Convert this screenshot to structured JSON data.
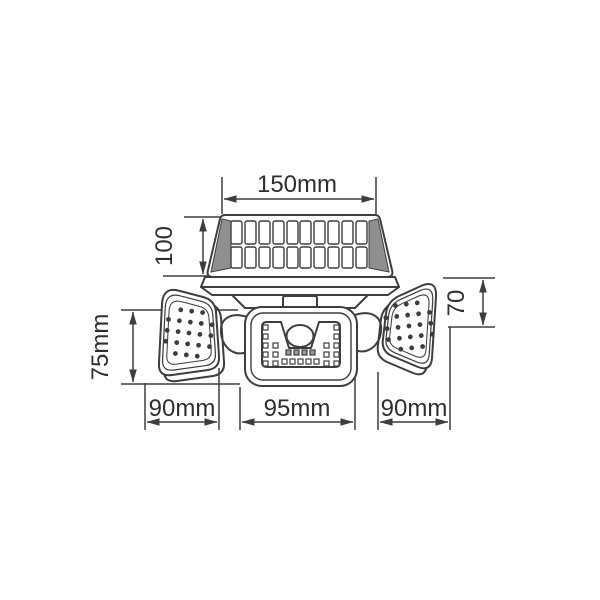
{
  "diagram": {
    "type": "technical-dimension-drawing",
    "labels": {
      "top_width": "150mm",
      "solar_panel_height": "100",
      "left_head_height": "75mm",
      "right_head_height": "70",
      "bottom_left_width": "90mm",
      "bottom_center_width": "95mm",
      "bottom_right_width": "90mm"
    },
    "colors": {
      "line": "#3d3d3d",
      "text": "#2e2e2e",
      "background": "#ffffff",
      "led_shade": "#9a9a9a"
    }
  }
}
